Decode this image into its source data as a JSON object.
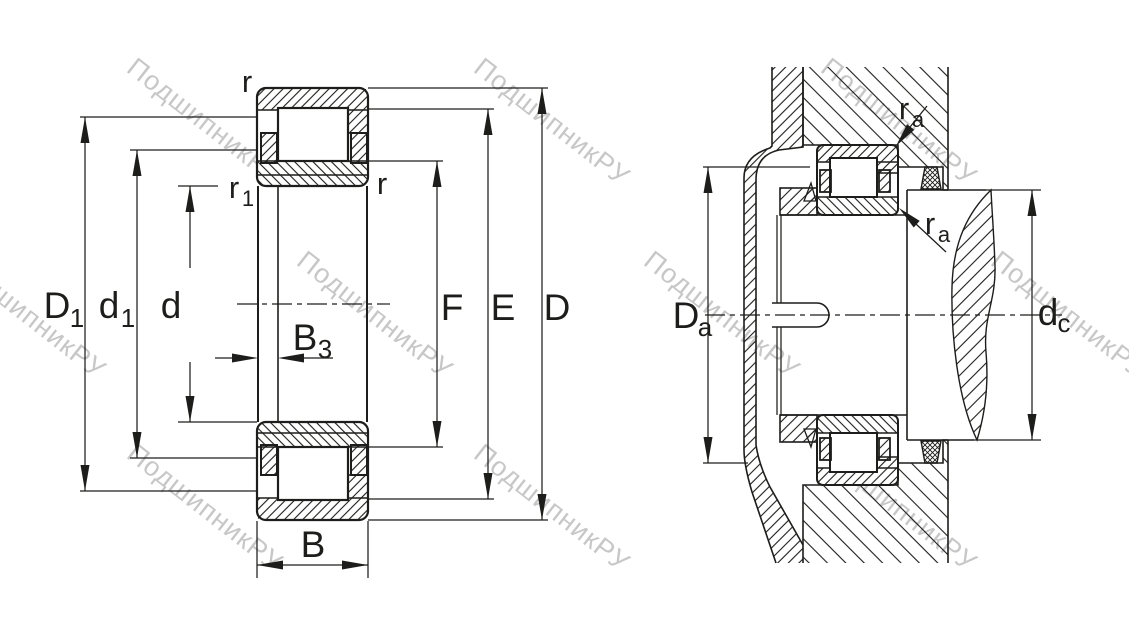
{
  "diagram": {
    "watermark": {
      "text": "ПодшипникРУ",
      "color": "#c7c7c7"
    },
    "line_color": "#1d1d1b",
    "left_view": {
      "labels": {
        "r_top": "r",
        "r1_main": "r",
        "r1_sub": "1",
        "r_right": "r",
        "D1_main": "D",
        "D1_sub": "1",
        "d1_main": "d",
        "d1_sub": "1",
        "d": "d",
        "B3_main": "B",
        "B3_sub": "3",
        "B": "B",
        "F": "F",
        "E": "E",
        "D": "D"
      }
    },
    "right_view": {
      "labels": {
        "ra_top_main": "r",
        "ra_top_sub": "a",
        "ra_bottom_main": "r",
        "ra_bottom_sub": "a",
        "Da_main": "D",
        "Da_sub": "a",
        "dc_main": "d",
        "dc_sub": "c"
      }
    }
  }
}
